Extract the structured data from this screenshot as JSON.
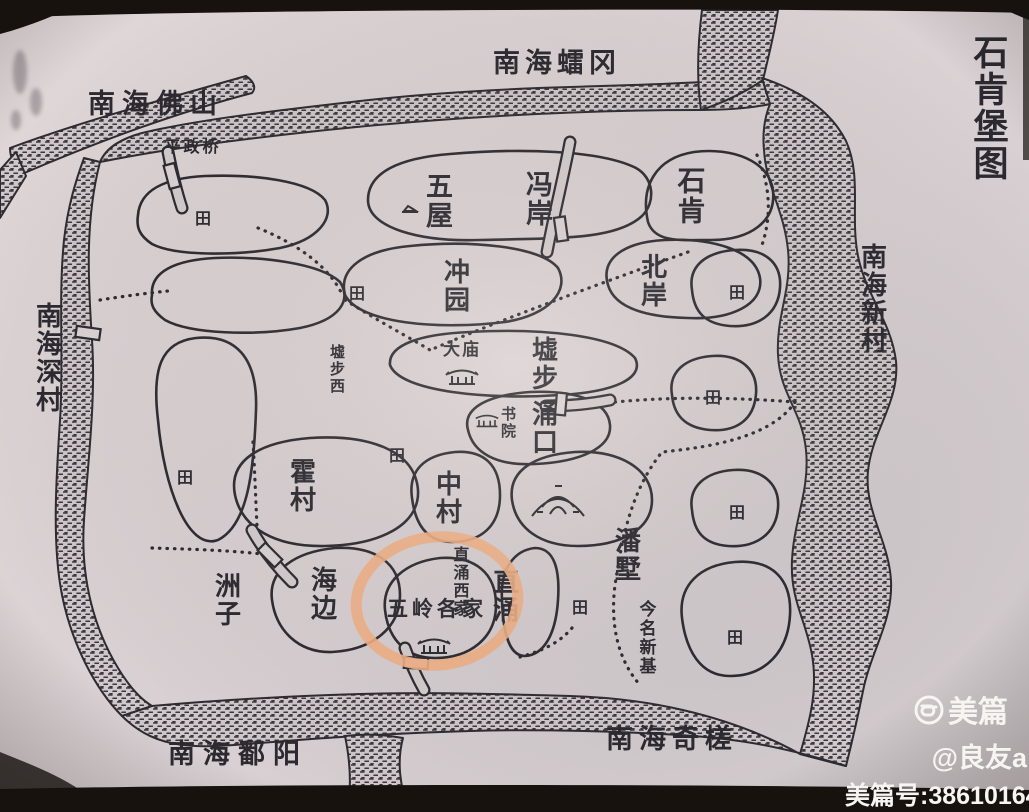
{
  "colors": {
    "paper": "#d9d1d3",
    "paper_dark": "#cfc8ca",
    "ink": "#2c2a30",
    "water_ink": "#3c383e",
    "highlight": "#f3b186",
    "frame": "#17120e",
    "watermark": "#f7f4f1"
  },
  "title": {
    "id": "map-title",
    "text": "石肯堡图",
    "x": 988,
    "y": 34,
    "o": "v",
    "s": 35
  },
  "region_labels": [
    {
      "id": "label-north-leigang",
      "text": "南海𧒽冈",
      "x": 557,
      "y": 72,
      "o": "h",
      "s": 27,
      "ls": 5
    },
    {
      "id": "label-northwest-foshan",
      "text": "南海佛山",
      "x": 156,
      "y": 113,
      "o": "h",
      "s": 27,
      "ls": 7
    },
    {
      "id": "label-pingzheng-bridge",
      "text": "平政桥",
      "x": 193,
      "y": 152,
      "o": "h",
      "s": 16,
      "ls": 3
    },
    {
      "id": "label-west-shencun",
      "text": "南海深村",
      "x": 47,
      "y": 302,
      "o": "v",
      "s": 26
    },
    {
      "id": "label-east-xincun",
      "text": "南海新村",
      "x": 872,
      "y": 243,
      "o": "v",
      "s": 26
    },
    {
      "id": "label-southwest-poyang",
      "text": "南海鄱阳",
      "x": 238,
      "y": 763,
      "o": "h",
      "s": 27,
      "ls": 8
    },
    {
      "id": "label-southeast-qicha",
      "text": "南海奇槎",
      "x": 672,
      "y": 748,
      "o": "h",
      "s": 27,
      "ls": 6
    }
  ],
  "village_labels": [
    {
      "id": "label-wuwu",
      "text": "五屋",
      "x": 437,
      "y": 172,
      "o": "v",
      "s": 27
    },
    {
      "id": "label-fengan",
      "text": "冯岸",
      "x": 537,
      "y": 170,
      "o": "v",
      "s": 27
    },
    {
      "id": "label-shiken",
      "text": "石肯",
      "x": 689,
      "y": 166,
      "o": "v",
      "s": 28
    },
    {
      "id": "label-beian",
      "text": "北岸",
      "x": 652,
      "y": 253,
      "o": "v",
      "s": 26
    },
    {
      "id": "label-chongyuan",
      "text": "冲园",
      "x": 455,
      "y": 258,
      "o": "v",
      "s": 26
    },
    {
      "id": "label-xubuxi",
      "text": "墟步西",
      "x": 336,
      "y": 344,
      "o": "v",
      "s": 15
    },
    {
      "id": "label-damiao",
      "text": "大庙",
      "x": 462,
      "y": 355,
      "o": "h",
      "s": 17,
      "ls": 2
    },
    {
      "id": "label-xubu",
      "text": "墟步",
      "x": 543,
      "y": 336,
      "o": "v",
      "s": 26
    },
    {
      "id": "label-shuyuan",
      "text": "书院",
      "x": 507,
      "y": 406,
      "o": "v",
      "s": 15
    },
    {
      "id": "label-yongkou",
      "text": "涌口",
      "x": 543,
      "y": 400,
      "o": "v",
      "s": 26
    },
    {
      "id": "label-zhongcun",
      "text": "中村",
      "x": 447,
      "y": 470,
      "o": "v",
      "s": 26
    },
    {
      "id": "label-huocun",
      "text": "霍村",
      "x": 301,
      "y": 458,
      "o": "v",
      "s": 26
    },
    {
      "id": "label-haibian",
      "text": "海边",
      "x": 322,
      "y": 566,
      "o": "v",
      "s": 26
    },
    {
      "id": "label-zhouzi",
      "text": "洲子",
      "x": 226,
      "y": 572,
      "o": "v",
      "s": 26
    },
    {
      "id": "label-zhichong-xijia",
      "text": "直涌西家",
      "x": 459,
      "y": 546,
      "o": "v",
      "s": 16
    },
    {
      "id": "label-wuling-gejia",
      "text": "五岭各家",
      "x": 437,
      "y": 616,
      "o": "h",
      "s": 21,
      "ls": 4
    },
    {
      "id": "label-zhichong",
      "text": "直涌",
      "x": 504,
      "y": 568,
      "o": "v",
      "s": 26
    },
    {
      "id": "label-panshu",
      "text": "潘墅",
      "x": 626,
      "y": 527,
      "o": "v",
      "s": 26
    },
    {
      "id": "label-jinming-xinji",
      "text": "今名新基",
      "x": 646,
      "y": 600,
      "o": "v",
      "s": 17
    }
  ],
  "field_marker": {
    "char": "田",
    "positions": [
      [
        203,
        218
      ],
      [
        357,
        293
      ],
      [
        397,
        455
      ],
      [
        185,
        477
      ],
      [
        737,
        292
      ],
      [
        713,
        397
      ],
      [
        737,
        512
      ],
      [
        580,
        607
      ],
      [
        735,
        637
      ]
    ]
  },
  "watermark": {
    "brand": "美篇",
    "handle": "@良友a",
    "meipian_id": "美篇号:38610164"
  }
}
